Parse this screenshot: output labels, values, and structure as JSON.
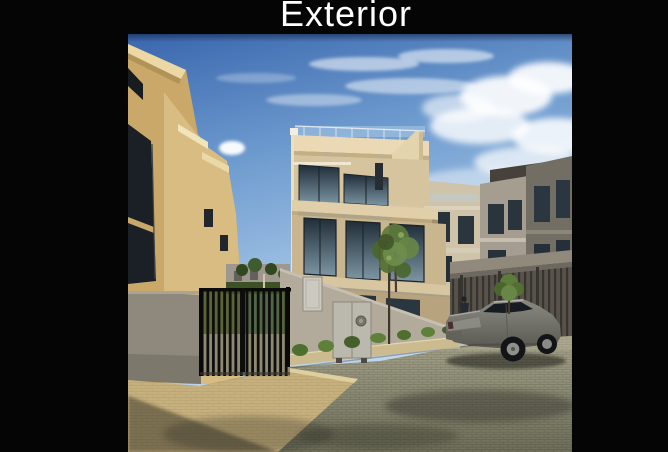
{
  "title": {
    "text": "Exterior"
  },
  "slide": {
    "background": "#050505",
    "title_color": "#ffffff"
  },
  "photo": {
    "alt": "Street-level photo of a modern residential compound: beige and grey multi-storey townhouses with large dark glass windows and rooftop glass balustrades, a black metal picket fence, grey utility cabinets on a concrete retaining wall, small green trees and shrubs, a parked grey sedan with a person standing behind it, and a cobblestone street with a beige paver sidewalk under a blue sky with white clouds",
    "palette": {
      "sky_blue": "#3e6db4",
      "cloud_white": "#f4f8fb",
      "tan_building": "#d2b273",
      "cream_building": "#d8c49a",
      "concrete_grey": "#a8a296",
      "glass_dark": "#253440",
      "foliage_green": "#5d7b3b",
      "street_pavers": "#96947c",
      "sidewalk_beige": "#c6b07e",
      "car_grey": "#77766f",
      "fence_black": "#101010"
    }
  }
}
